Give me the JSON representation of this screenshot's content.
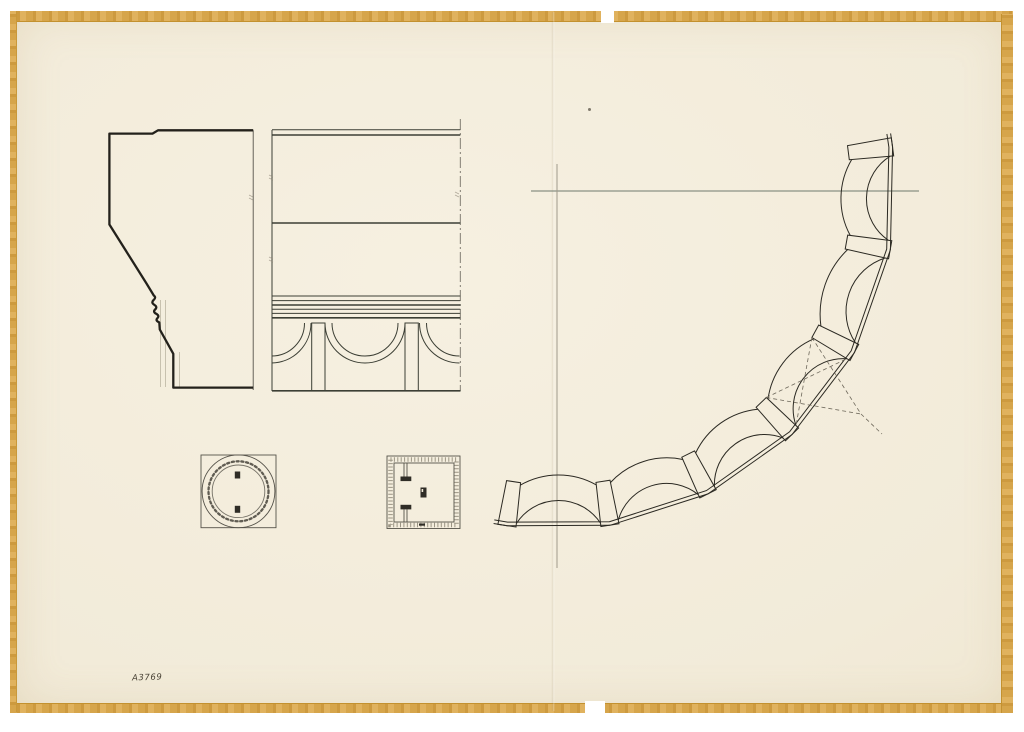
{
  "document": {
    "inventory_number": "A3769"
  },
  "colors": {
    "background": "#ffffff",
    "paper": "#f2ebd9",
    "mounting_tape": "#d6a54b",
    "ink": "#2b2922",
    "construction_line": "#6d675a",
    "axis_line": "#6f7a6e"
  }
}
